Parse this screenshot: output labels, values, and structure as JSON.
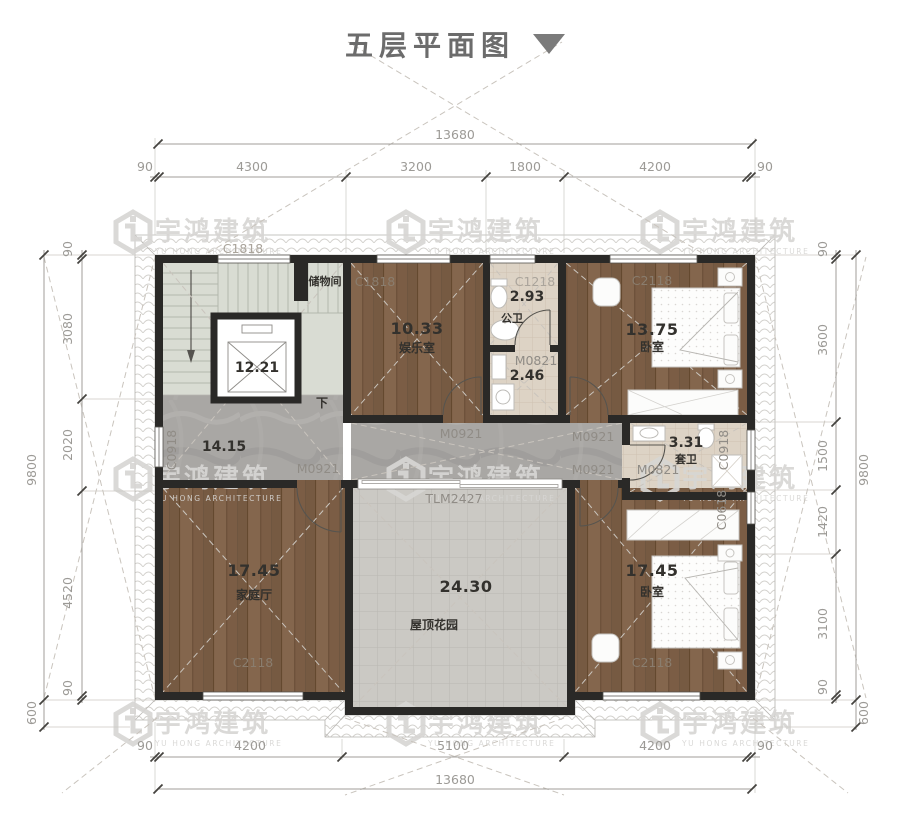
{
  "title": {
    "text": "五层平面图"
  },
  "watermark": {
    "cn": "宇鸿建筑",
    "en": "YU HONG ARCHITECTURE"
  },
  "dims": {
    "top": {
      "total": "13680",
      "segments": [
        "90",
        "4300",
        "3200",
        "1800",
        "4200",
        "90"
      ]
    },
    "bottom": {
      "total": "13680",
      "segments": [
        "90",
        "4200",
        "5100",
        "4200",
        "90"
      ]
    },
    "left": {
      "total": "9800",
      "overhang": "600",
      "segments": [
        "90",
        "3080",
        "2020",
        "4520",
        "90"
      ]
    },
    "right": {
      "total": "9800",
      "overhang": "600",
      "segments": [
        "90",
        "3600",
        "1500",
        "1420",
        "3100",
        "90"
      ]
    }
  },
  "rooms": {
    "storage": {
      "name": "储物间"
    },
    "elevator": {
      "area": "12.21"
    },
    "entertainment": {
      "name": "娱乐室",
      "area": "10.33"
    },
    "public_bath": {
      "name": "公卫",
      "area": "2.93"
    },
    "utility": {
      "area": "2.46"
    },
    "bedroom_top": {
      "name": "卧室",
      "area": "13.75"
    },
    "hallway": {
      "area": "14.15"
    },
    "ensuite": {
      "name": "套卫",
      "area": "3.31"
    },
    "family": {
      "name": "家庭厅",
      "area": "17.45"
    },
    "garden": {
      "name": "屋顶花园",
      "area": "24.30"
    },
    "bedroom_bottom": {
      "name": "卧室",
      "area": "17.45"
    },
    "stair_down": "下"
  },
  "codes": {
    "c1818_eave": "C1818",
    "c1818_ent": "C1818",
    "c1218": "C1218",
    "c2118_top": "C2118",
    "c0918_left": "C0918",
    "c0918_right": "C0918",
    "c0618_right": "C0618",
    "c2118_family": "C2118",
    "c2118_bed": "C2118",
    "m0921_ent": "M0921",
    "m0921_bed_top": "M0921",
    "m0921_family": "M0921",
    "m0921_bed_bottom": "M0921",
    "m0821_utility": "M0821",
    "m0821_ensuite": "M0821",
    "tlm": "TLM2427"
  },
  "colors": {
    "wall": "#2a2927",
    "wood": "#7e6049",
    "marble": "#a9a7a4",
    "accent_text": "#33312d"
  }
}
